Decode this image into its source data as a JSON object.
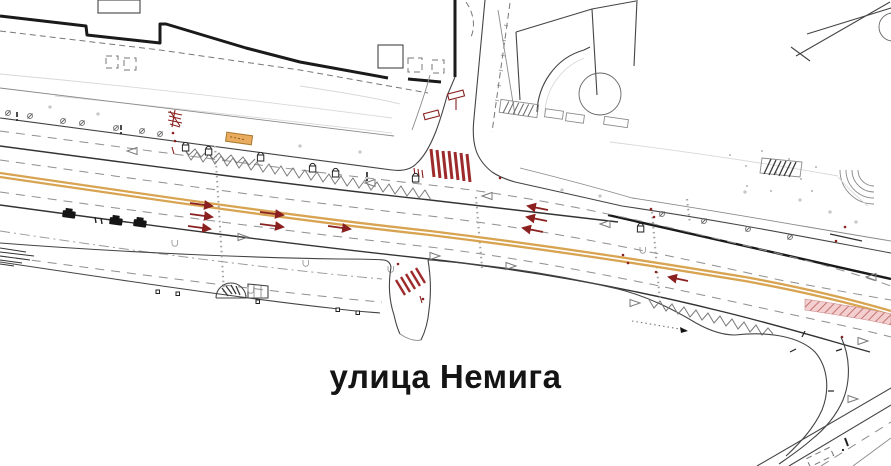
{
  "title": "улица Немига",
  "drawing": {
    "kind": "street-traffic-plan",
    "street_label": "улица Немига"
  },
  "colors": {
    "background": "#ffffff",
    "line-primary": "#1a1a1a",
    "line-secondary": "#808080",
    "centerline-orange": "#d8a452",
    "marking-red": "#8b2020",
    "crossing-red": "#9e2b2b",
    "island-pink-fill": "#f3cfcf",
    "island-pink-hatch": "#c06868",
    "bus-stop-orange": "#e9ab5e",
    "label-text": "#141414"
  }
}
